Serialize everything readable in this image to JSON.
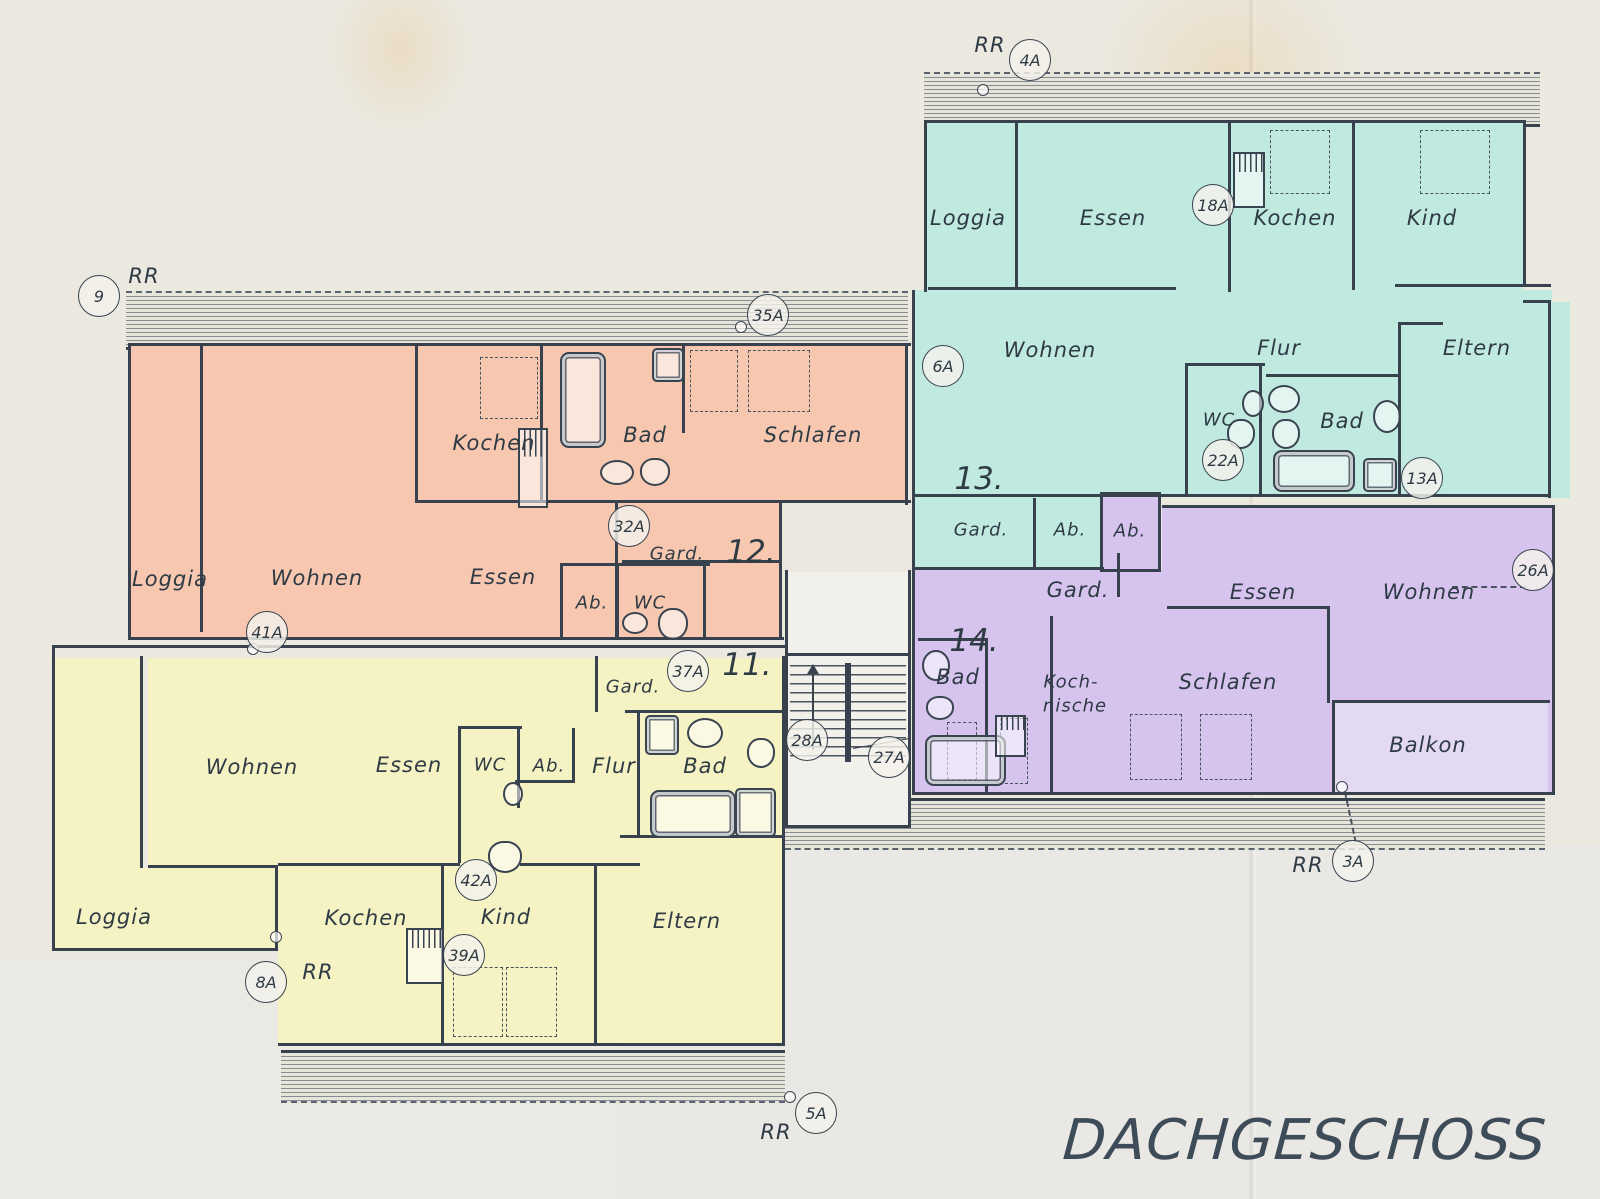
{
  "title": "DACHGESCHOSS",
  "rr": "RR",
  "apartments": [
    {
      "number": "12.",
      "color": "#f7c7af",
      "rooms": [
        "Kochen",
        "Bad",
        "Schlafen",
        "Loggia",
        "Wohnen",
        "Essen",
        "Gard.",
        "Ab.",
        "WC"
      ]
    },
    {
      "number": "11.",
      "color": "#f5f2c4",
      "rooms": [
        "Gard.",
        "Wohnen",
        "Essen",
        "WC",
        "Ab.",
        "Flur",
        "Bad",
        "Loggia",
        "Kochen",
        "Kind",
        "Eltern"
      ]
    },
    {
      "number": "13.",
      "color": "#c0e9e0",
      "rooms": [
        "Loggia",
        "Essen",
        "Kochen",
        "Kind",
        "Wohnen",
        "Flur",
        "Eltern",
        "WC",
        "Bad",
        "Gard.",
        "Ab."
      ]
    },
    {
      "number": "14.",
      "color": "#d6c4ef",
      "rooms": [
        "Ab.",
        "Gard.",
        "Essen",
        "Wohnen",
        "Bad",
        "Koch-",
        "nische",
        "Schlafen",
        "Balkon"
      ]
    }
  ],
  "balkon_color": "#e3d9f3",
  "markers": [
    "9",
    "4A",
    "35A",
    "18A",
    "6A",
    "22A",
    "13A",
    "26A",
    "32A",
    "41A",
    "37A",
    "28A",
    "27A",
    "42A",
    "39A",
    "8A",
    "5A",
    "3A"
  ]
}
